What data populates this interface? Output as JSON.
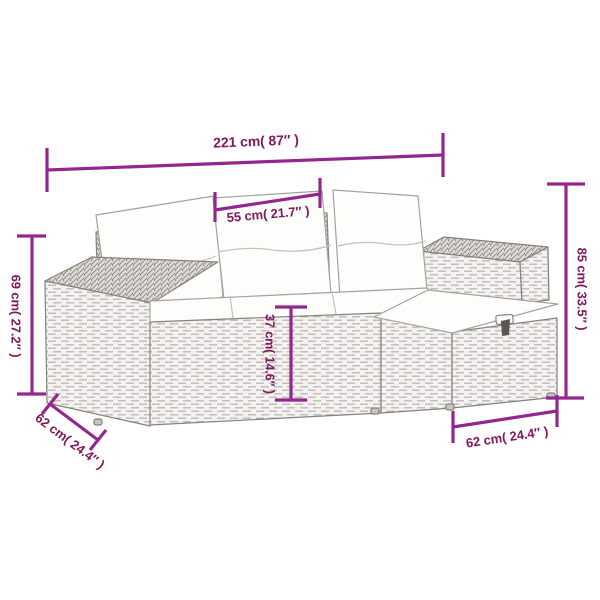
{
  "colors": {
    "dimension_line": "#93278F",
    "dimension_text": "#801A5F",
    "sofa_outline": "#85827C",
    "wicker_fill": "#F3F2F0",
    "wicker_top_fill": "#E0DDD9",
    "cushion_fill": "#FDFDFC",
    "background": "#FFFFFF"
  },
  "dimensions": {
    "total_width": {
      "label": "221 cm( 87″ )"
    },
    "center_seat_width": {
      "label": "55 cm( 21.7″ )"
    },
    "total_height": {
      "label": "85 cm( 33.5″ )"
    },
    "armrest_height": {
      "label": "69 cm( 27.2″ )"
    },
    "seat_height": {
      "label": "37 cm( 14.6″ )"
    },
    "sofa_depth": {
      "label": "62 cm( 24.4″ )"
    },
    "footstool_width": {
      "label": "62 cm( 24.4″ )"
    }
  },
  "illustration": {
    "description": "Line drawing of a grey poly-rattan garden lounge set: left armrest, three back cushions, seat cushions, right armrest and an L-shaped footstool with storage latch"
  }
}
